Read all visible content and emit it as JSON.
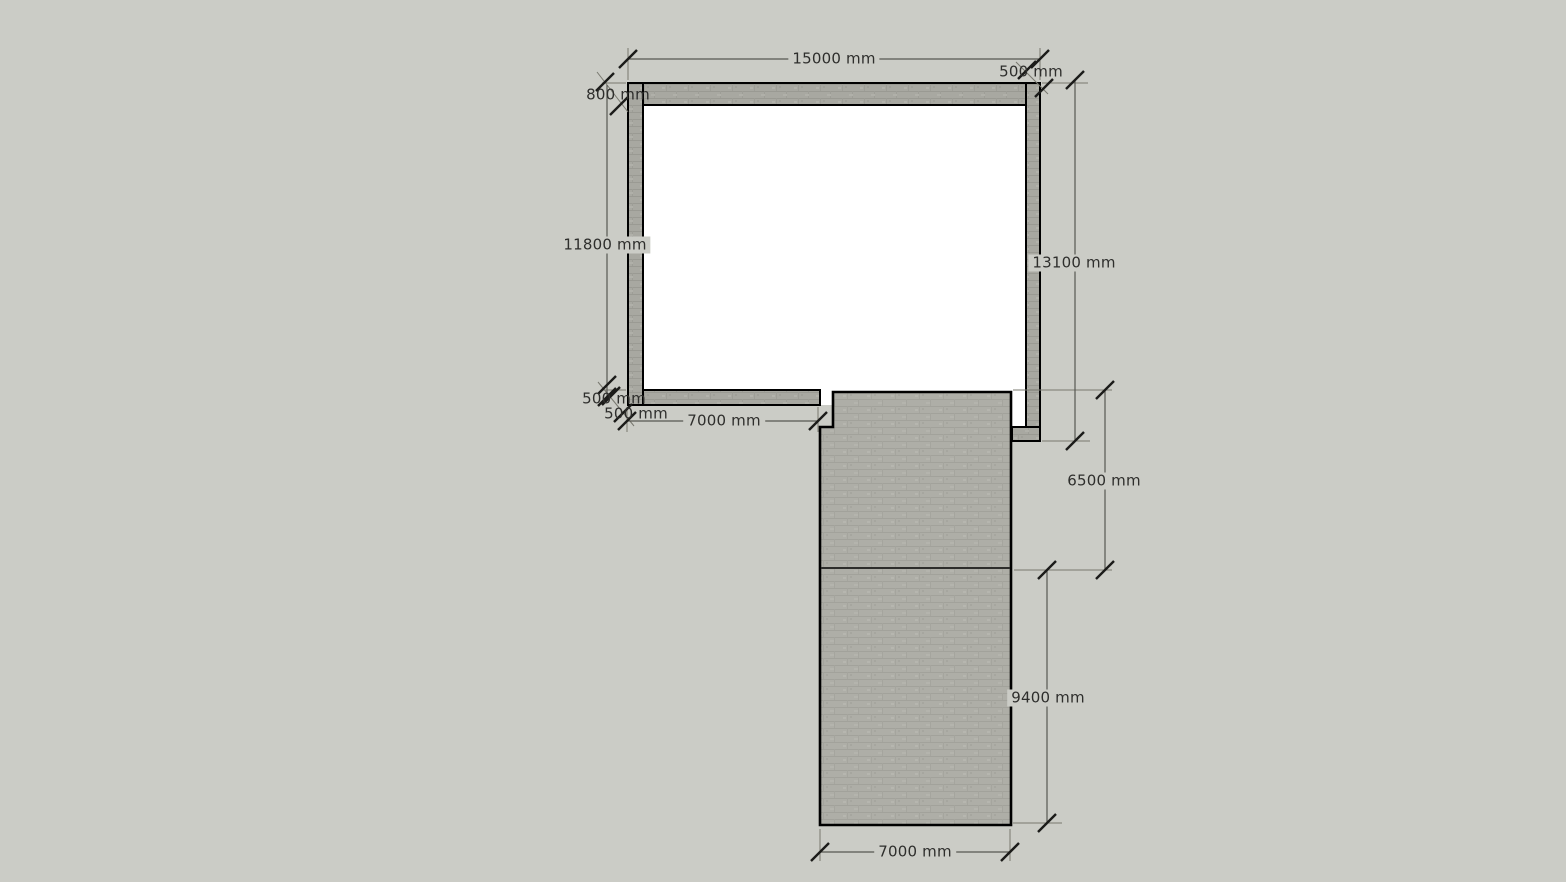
{
  "scene": {
    "type": "floor-plan-cad-drawing",
    "unit": "mm",
    "colors": {
      "canvas_background": "#cbccc6",
      "wall_fill": "#a8a8a1",
      "slab_fill": "#aeaea7",
      "outline": "#000000",
      "dimension_line": "#575752",
      "dimension_text": "#2e2e2c",
      "room_interior": "#ffffff"
    }
  },
  "dims": {
    "overall_width": "15000 mm",
    "right_wall_thickness": "500 mm",
    "top_wall_thickness": "800 mm",
    "left_height": "11800 mm",
    "right_height": "13100 mm",
    "bottom_wall_thickness": "500 mm",
    "left_wall_thickness": "500 mm",
    "bottom_wall_length": "7000 mm",
    "corridor_upper_length": "6500 mm",
    "corridor_lower_length": "9400 mm",
    "corridor_width": "7000 mm"
  }
}
